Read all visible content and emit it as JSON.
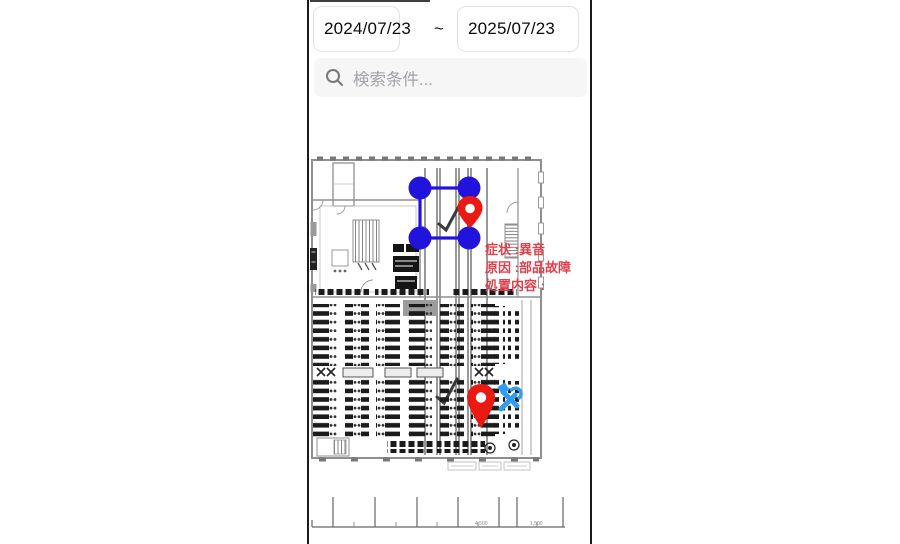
{
  "frame": {
    "background": "#ffffff",
    "border_color": "#1a1a1a"
  },
  "toolbar": {
    "date_start": "2024/07/23",
    "range_separator": "~",
    "date_end": "2025/07/23"
  },
  "search": {
    "placeholder": "検索条件...",
    "icon": "magnifier"
  },
  "map": {
    "annotation": {
      "line1": "症状 :異音",
      "line2": "原因 :部品故障",
      "line3": "処置内容 :",
      "color": "#e2404b"
    },
    "markers": {
      "selection_rectangle_color": "#2113dc",
      "pin_color": "#ea1a12",
      "tools_color": "#2e9df2"
    },
    "ruler_labels": {
      "a": "4,500",
      "b": "1,500"
    }
  }
}
